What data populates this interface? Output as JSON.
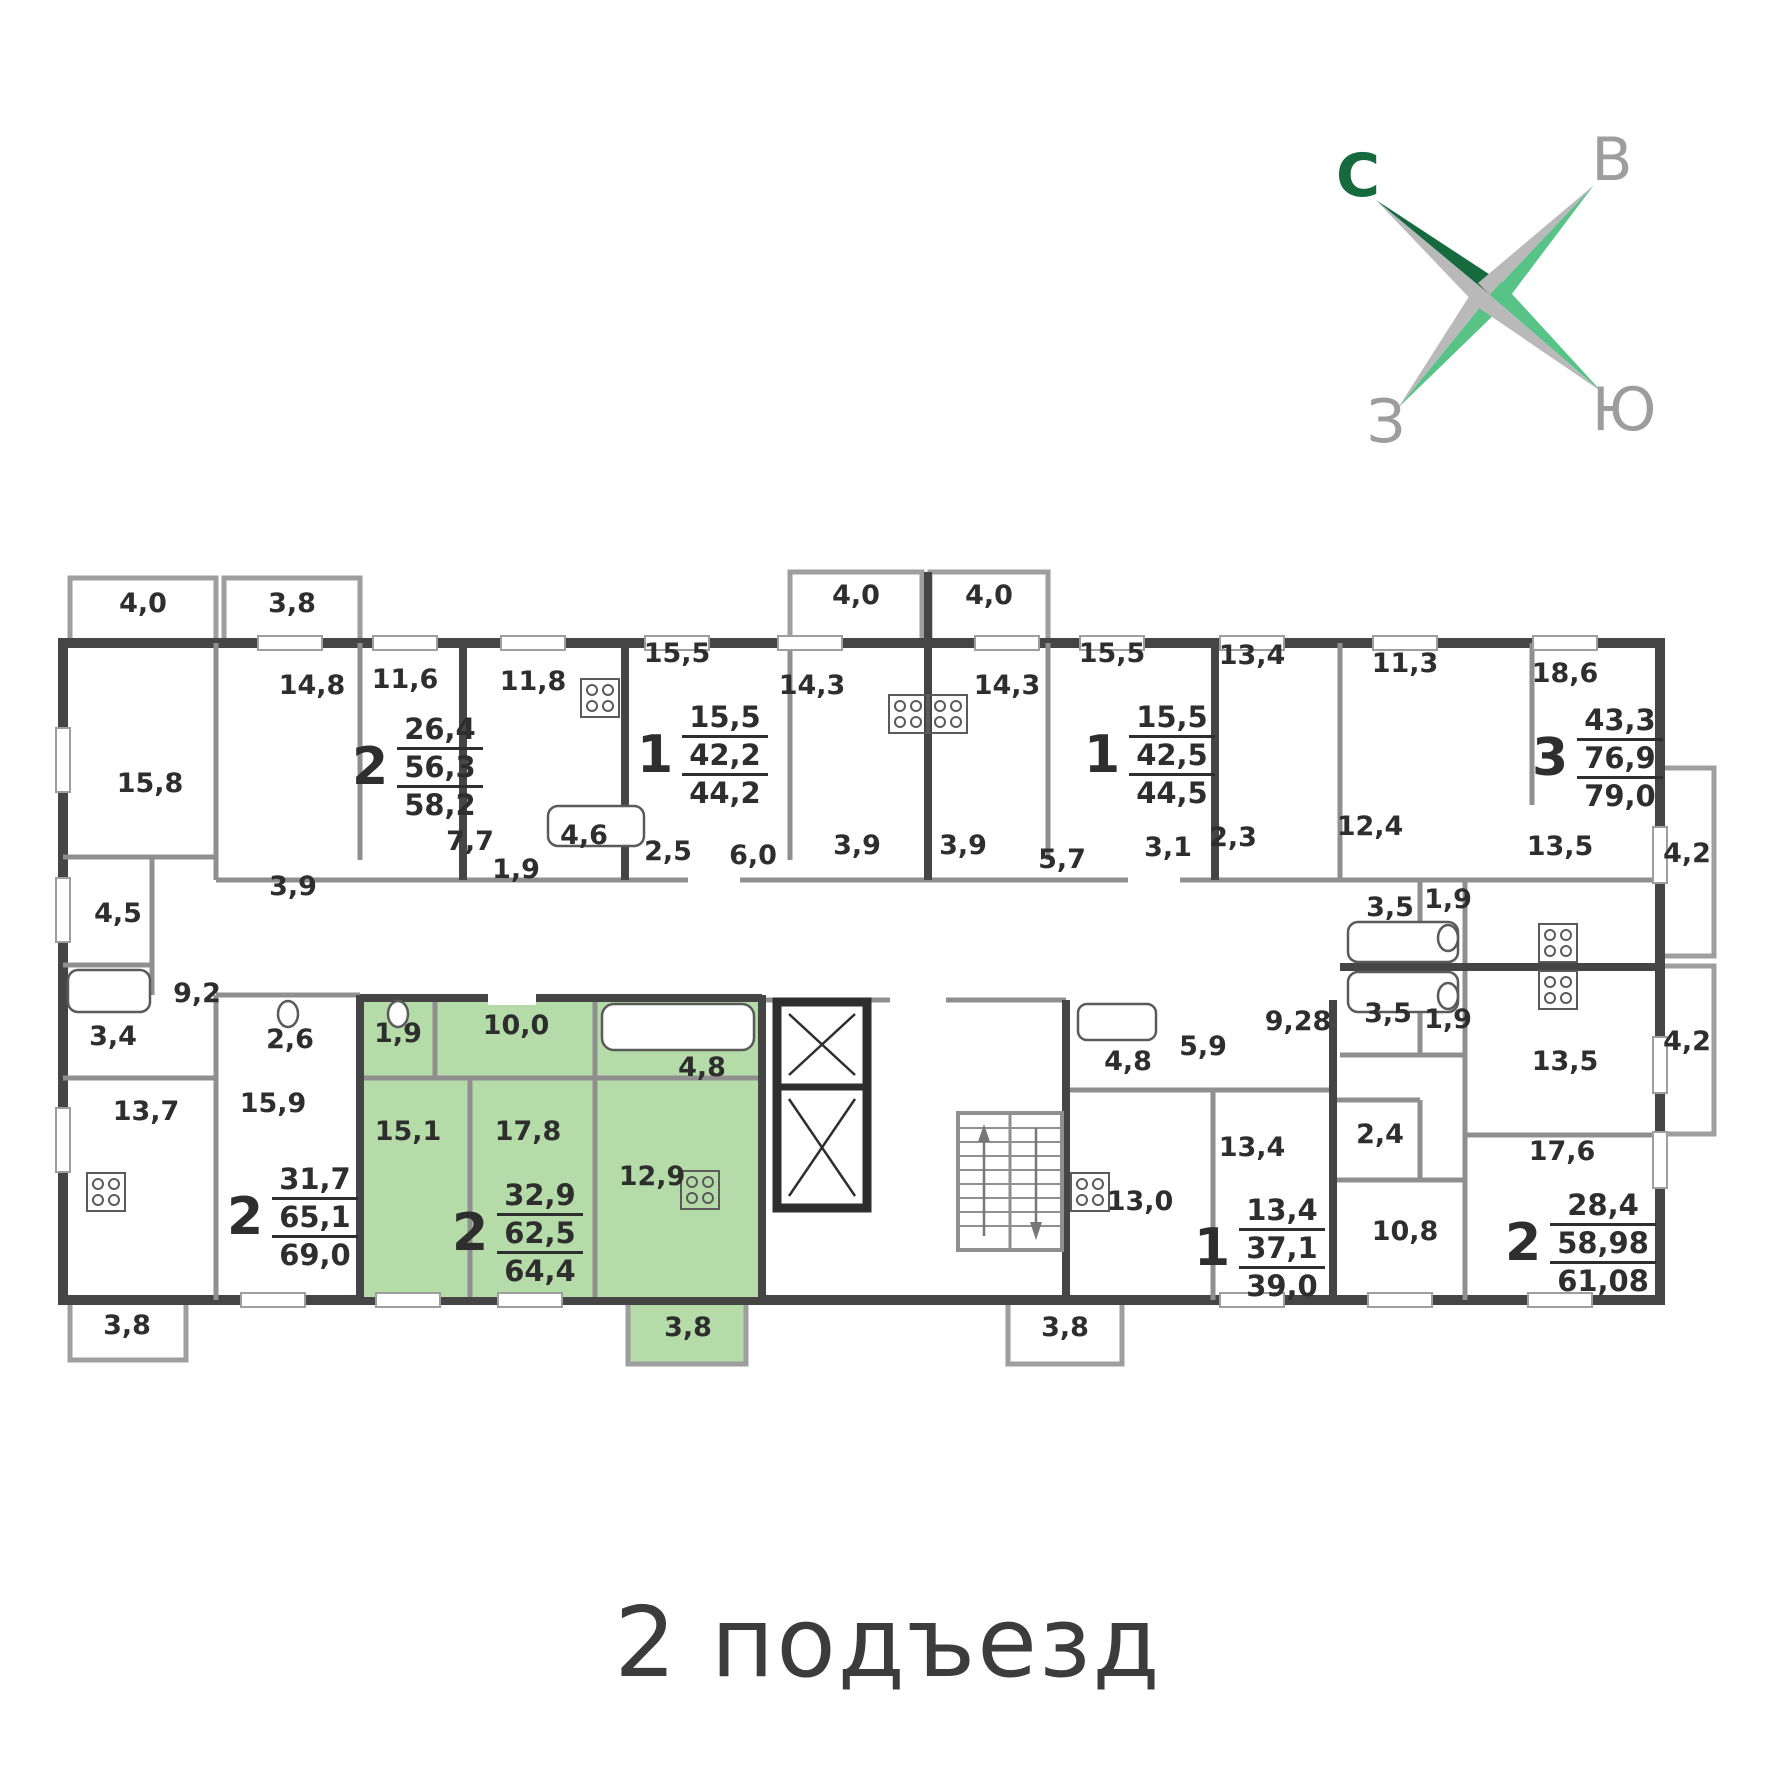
{
  "title": "2 подъезд",
  "compass": {
    "north": "С",
    "east": "В",
    "west": "З",
    "south": "Ю"
  },
  "colors": {
    "highlight_green": "#b5dca8",
    "wall_dark": "#454545",
    "wall_mid": "#8f8f8f",
    "compass_dark_green": "#156b3d",
    "compass_light_green": "#57c387",
    "compass_gray": "#b9b9b9",
    "label_ink": "#2e2e2e"
  },
  "apartments": [
    {
      "rooms": "2",
      "living": "26,4",
      "area": "56,3",
      "total": "58,2",
      "x": 352,
      "y": 712,
      "highlight": false
    },
    {
      "rooms": "1",
      "living": "15,5",
      "area": "42,2",
      "total": "44,2",
      "x": 637,
      "y": 700,
      "highlight": false
    },
    {
      "rooms": "1",
      "living": "15,5",
      "area": "42,5",
      "total": "44,5",
      "x": 1084,
      "y": 700,
      "highlight": false
    },
    {
      "rooms": "3",
      "living": "43,3",
      "area": "76,9",
      "total": "79,0",
      "x": 1532,
      "y": 703,
      "highlight": false
    },
    {
      "rooms": "2",
      "living": "31,7",
      "area": "65,1",
      "total": "69,0",
      "x": 227,
      "y": 1162,
      "highlight": false
    },
    {
      "rooms": "2",
      "living": "32,9",
      "area": "62,5",
      "total": "64,4",
      "x": 452,
      "y": 1178,
      "highlight": true
    },
    {
      "rooms": "1",
      "living": "13,4",
      "area": "37,1",
      "total": "39,0",
      "x": 1194,
      "y": 1193,
      "highlight": false
    },
    {
      "rooms": "2",
      "living": "28,4",
      "area": "58,98",
      "total": "61,08",
      "x": 1505,
      "y": 1188,
      "highlight": false
    }
  ],
  "room_labels": [
    {
      "t": "4,0",
      "x": 143,
      "y": 612
    },
    {
      "t": "3,8",
      "x": 292,
      "y": 612
    },
    {
      "t": "4,0",
      "x": 856,
      "y": 604
    },
    {
      "t": "4,0",
      "x": 989,
      "y": 604
    },
    {
      "t": "15,8",
      "x": 150,
      "y": 792
    },
    {
      "t": "14,8",
      "x": 312,
      "y": 694
    },
    {
      "t": "11,6",
      "x": 405,
      "y": 688
    },
    {
      "t": "11,8",
      "x": 533,
      "y": 690
    },
    {
      "t": "15,5",
      "x": 677,
      "y": 662
    },
    {
      "t": "14,3",
      "x": 812,
      "y": 694
    },
    {
      "t": "14,3",
      "x": 1007,
      "y": 694
    },
    {
      "t": "15,5",
      "x": 1112,
      "y": 662
    },
    {
      "t": "13,4",
      "x": 1252,
      "y": 664
    },
    {
      "t": "11,3",
      "x": 1405,
      "y": 672
    },
    {
      "t": "18,6",
      "x": 1565,
      "y": 682
    },
    {
      "t": "7,7",
      "x": 470,
      "y": 850
    },
    {
      "t": "1,9",
      "x": 516,
      "y": 878
    },
    {
      "t": "4,6",
      "x": 584,
      "y": 844
    },
    {
      "t": "2,5",
      "x": 668,
      "y": 860
    },
    {
      "t": "6,0",
      "x": 753,
      "y": 864
    },
    {
      "t": "3,9",
      "x": 857,
      "y": 854
    },
    {
      "t": "3,9",
      "x": 963,
      "y": 854
    },
    {
      "t": "5,7",
      "x": 1062,
      "y": 868
    },
    {
      "t": "3,1",
      "x": 1168,
      "y": 856
    },
    {
      "t": "2,3",
      "x": 1233,
      "y": 846
    },
    {
      "t": "12,4",
      "x": 1370,
      "y": 835
    },
    {
      "t": "13,5",
      "x": 1560,
      "y": 855
    },
    {
      "t": "4,2",
      "x": 1687,
      "y": 862
    },
    {
      "t": "3,9",
      "x": 293,
      "y": 895
    },
    {
      "t": "4,5",
      "x": 118,
      "y": 922
    },
    {
      "t": "9,2",
      "x": 197,
      "y": 1002
    },
    {
      "t": "3,4",
      "x": 113,
      "y": 1045
    },
    {
      "t": "2,6",
      "x": 290,
      "y": 1048
    },
    {
      "t": "13,7",
      "x": 146,
      "y": 1120
    },
    {
      "t": "15,9",
      "x": 273,
      "y": 1112
    },
    {
      "t": "1,9",
      "x": 398,
      "y": 1042
    },
    {
      "t": "10,0",
      "x": 516,
      "y": 1034
    },
    {
      "t": "4,8",
      "x": 702,
      "y": 1076
    },
    {
      "t": "15,1",
      "x": 408,
      "y": 1140
    },
    {
      "t": "17,8",
      "x": 528,
      "y": 1140
    },
    {
      "t": "12,9",
      "x": 652,
      "y": 1185
    },
    {
      "t": "4,8",
      "x": 1128,
      "y": 1070
    },
    {
      "t": "5,9",
      "x": 1203,
      "y": 1055
    },
    {
      "t": "9,28",
      "x": 1298,
      "y": 1030
    },
    {
      "t": "13,0",
      "x": 1140,
      "y": 1210
    },
    {
      "t": "13,4",
      "x": 1252,
      "y": 1156
    },
    {
      "t": "2,4",
      "x": 1380,
      "y": 1143
    },
    {
      "t": "10,8",
      "x": 1405,
      "y": 1240
    },
    {
      "t": "3,5",
      "x": 1390,
      "y": 916
    },
    {
      "t": "1,9",
      "x": 1448,
      "y": 908
    },
    {
      "t": "3,5",
      "x": 1388,
      "y": 1022
    },
    {
      "t": "1,9",
      "x": 1448,
      "y": 1028
    },
    {
      "t": "13,5",
      "x": 1565,
      "y": 1070
    },
    {
      "t": "17,6",
      "x": 1562,
      "y": 1160
    },
    {
      "t": "4,2",
      "x": 1687,
      "y": 1050
    },
    {
      "t": "3,8",
      "x": 127,
      "y": 1334
    },
    {
      "t": "3,8",
      "x": 688,
      "y": 1336
    },
    {
      "t": "3,8",
      "x": 1065,
      "y": 1336
    }
  ]
}
